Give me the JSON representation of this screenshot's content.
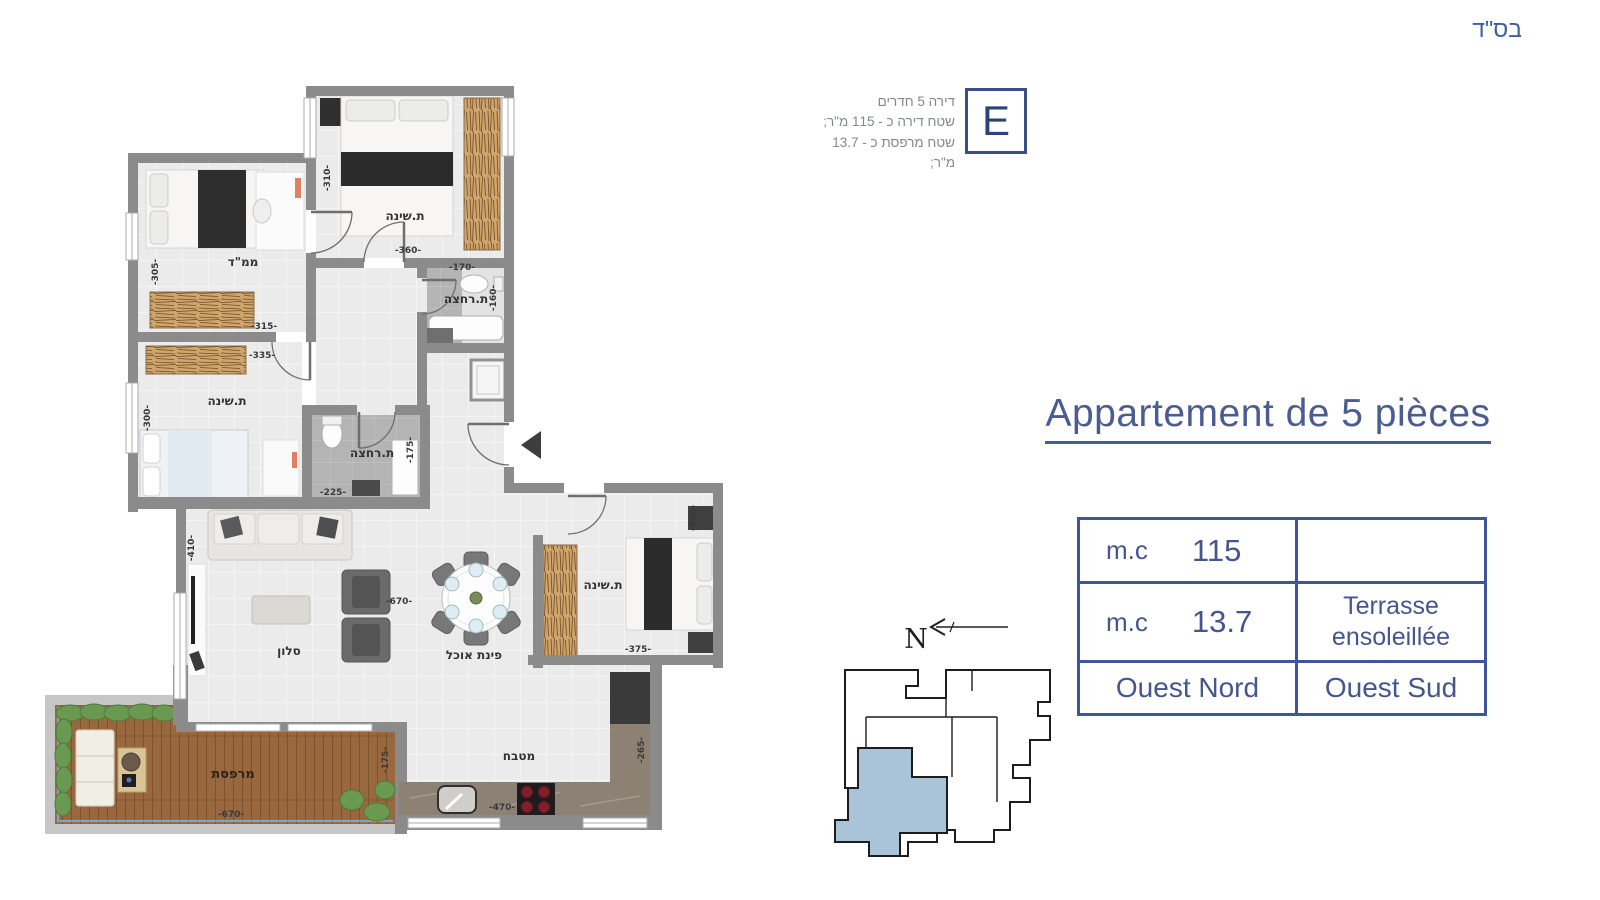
{
  "bsd": "בס\"ד",
  "unit_info": {
    "letter": "E",
    "line1": "דירה 5 חדרים",
    "line2": "שטח דירה כ - 115 מ\"ר;",
    "line3": "שטח מרפסת כ - 13.7 מ\"ר;"
  },
  "title": "Appartement de 5 pièces",
  "table": {
    "r1c1_label": "m.c",
    "r1c1_value": "115",
    "r2c1_label": "m.c",
    "r2c1_value": "13.7",
    "r2c2_line1": "Terrasse",
    "r2c2_line2": "ensoleillée",
    "r3c1": "Ouest Nord",
    "r3c2": "Ouest Sud"
  },
  "compass_label": "N",
  "plan": {
    "labels": {
      "bedroom": "ת.שינה",
      "mamad": "ממ\"ד",
      "bath": "ת.רחצה",
      "salon": "סלון",
      "dining": "פינת אוכל",
      "kitchen": "מטבח",
      "terrace": "מרפסת"
    },
    "dims": {
      "d310": "-310-",
      "d360": "-360-",
      "d305": "-305-",
      "d315": "-315-",
      "d335": "-335-",
      "d300": "-300-",
      "d170": "-170-",
      "d160": "-160-",
      "d175": "-175-",
      "d225": "-225-",
      "d410": "-410-",
      "d670": "-670-",
      "d340": "-340-",
      "d375": "-375-",
      "d470": "-470-",
      "d265": "-265-"
    }
  },
  "colors": {
    "accent": "#44568c",
    "table_border": "#3f569a",
    "wall": "#8b8b8b",
    "unit_highlight": "#a9c3d9"
  }
}
